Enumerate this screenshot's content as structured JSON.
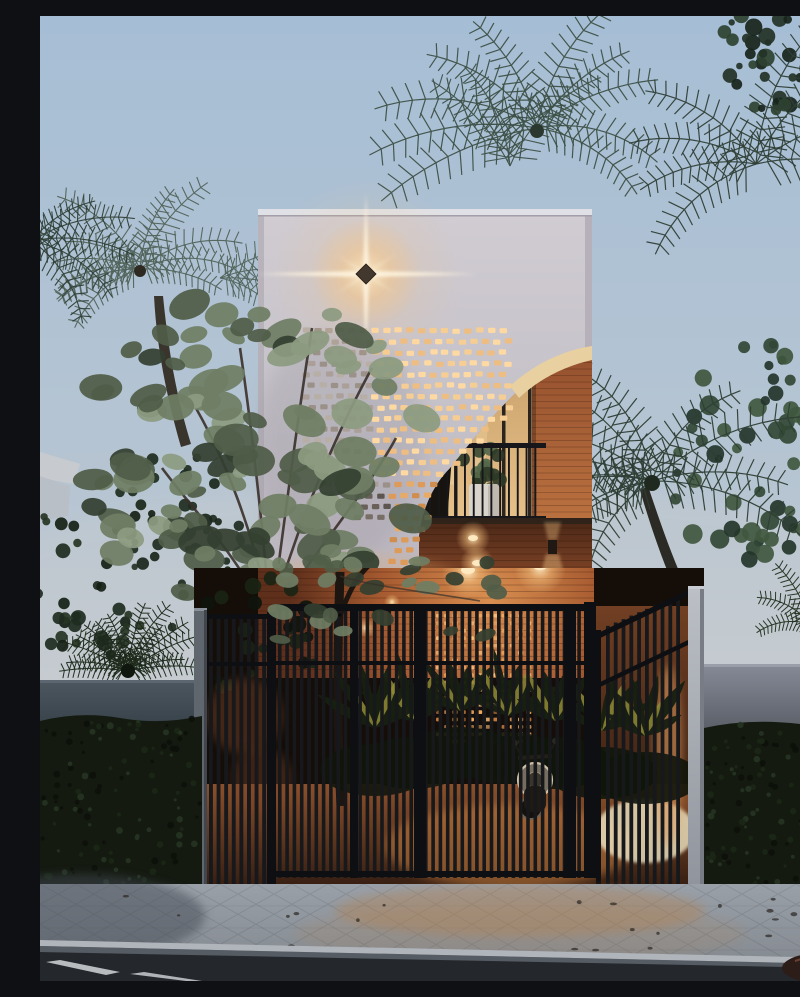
{
  "image": {
    "kind": "architectural-exterior-render",
    "time_of_day": "dusk",
    "subject": "narrow two-storey tropical house with perforated brick screen facade, arched balcony, slatted entrance gate, palm trees and street"
  },
  "objects": [
    "dusk-sky",
    "palm-trees",
    "background-foliage",
    "street-tree",
    "sago-palm",
    "house-facade",
    "roof-coping",
    "wall-star-light",
    "perforated-brick-screen",
    "arched-balcony-opening",
    "arch-soffit",
    "brick-pier",
    "glass-doors",
    "balcony-railing",
    "potted-plant-dark",
    "potted-plant-white",
    "under-balcony-brick-wall",
    "downlights",
    "wall-sconce",
    "entrance-gate",
    "gate-left-panel",
    "gate-right-panel",
    "gate-post",
    "gate-pillar",
    "courtyard-brick-wall",
    "glowing-perforations",
    "courtyard-plants",
    "scooter",
    "boundary-wall-left",
    "boundary-wall-right",
    "hedge-left",
    "hedge-right",
    "paved-sidewalk",
    "curb",
    "road",
    "road-marking",
    "distant-building"
  ],
  "palette": {
    "sky_top": "#a6bed5",
    "sky_mid": "#b7c5d2",
    "sky_horizon": "#c9cdd1",
    "sky_low": "#cccfd2",
    "facade_top": "#d0ccd2",
    "facade": "#c6c2c9",
    "facade_low": "#b9b4bd",
    "facade_edge": "#aaa5ae",
    "side_face": "#b5b0b9",
    "coping": "#e0e1e6",
    "coping_shadow": "#a39ea7",
    "star_core": "#ffeec8",
    "star_ray": "#fff6e2",
    "fixture": "#43382e",
    "hole_bright": "#f6cd92",
    "hole_warm": "#de9a58",
    "hole_grey": "#aaa099",
    "hole_dim": "#69605a",
    "soffit": "#e9d0a0",
    "pier_top": "#94502e",
    "pier_low": "#d08449",
    "glass_top": "#c79f6a",
    "glass_low": "#e7c18a",
    "glass_hi": "#eed5a6",
    "frame": "#2b241e",
    "rail": "#17171b",
    "light_hot": "#ffe9c0",
    "backdrop_dark": "#140d08",
    "brick_hot": "#d98f50",
    "brick_mid": "#a65a30",
    "brick_dark": "#5e2f1b",
    "glow_holes": "#f2a95e",
    "ground_warm": "#8a4f2a",
    "ground_dark": "#2e1a10",
    "plant_dark": "#18200f",
    "plant_glow": "#8f8b34",
    "bright_patch": "#efe6c2",
    "scooter_rim": "#cfc0a8",
    "scooter_body": "#1f1a14",
    "slat": "#17181c",
    "gate_frame": "#0e0f12",
    "post_grey": "#5f666e",
    "pillar_hi": "#bcc0c6",
    "pillar_lo": "#8f939b",
    "wall_left_top": "#4b565f",
    "wall_left_low": "#323b43",
    "wall_right_top": "#858996",
    "wall_right_low": "#565a62",
    "hedge": "#141a10",
    "hedge_hi": "#263424",
    "hedge_dot": "#0c110a",
    "tree1": "#6f7e64",
    "tree2": "#8c9b80",
    "tree3": "#505d48",
    "tree4": "#343f30",
    "branch": "#38302a",
    "trunk": "#29231c",
    "palm1": "#3d5047",
    "palm2": "#51635a",
    "palm3": "#2f3f37",
    "palm_dark": "#2e3e34",
    "bgleaf1": "#2b3b2e",
    "bgleaf2": "#1e2b20",
    "bgleaf3": "#3c4e3c",
    "pave": "#9aa0a8",
    "pave_low": "#83898f",
    "curb": "#b0b4bb",
    "curb_face": "#565c63",
    "road": "#24282d",
    "road_line": "#d3d6d9",
    "distant_bldg": "#c8cbd0",
    "glow_warm": "#e8a763"
  }
}
